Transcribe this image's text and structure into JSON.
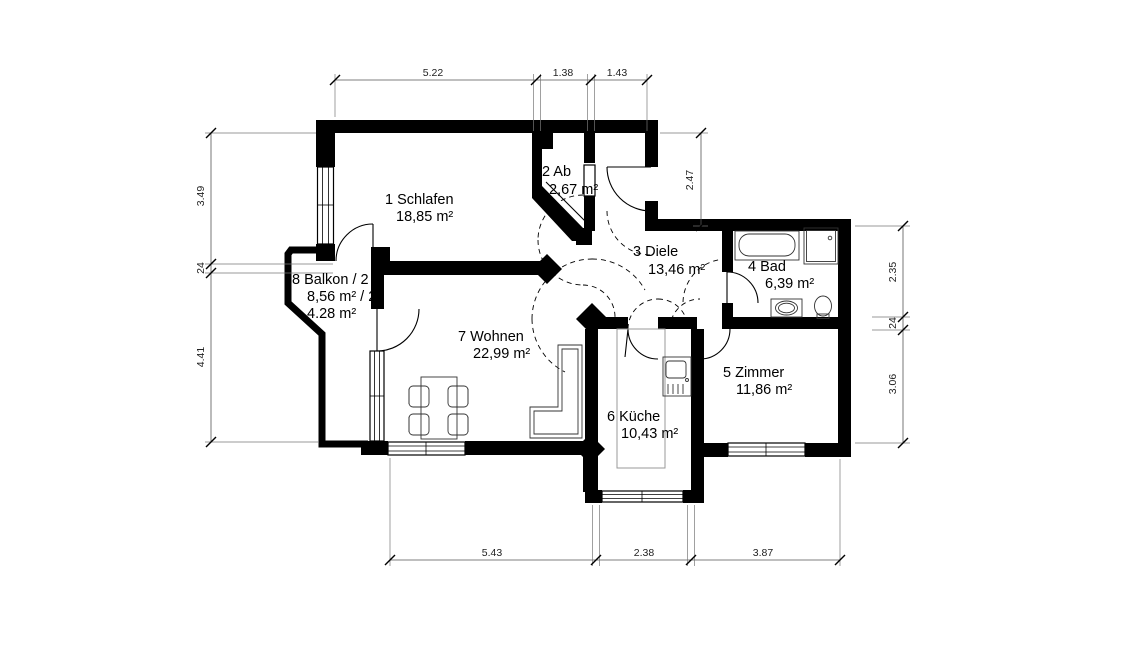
{
  "rooms": [
    {
      "label": "1  Schlafen",
      "area": "18,85 m²"
    },
    {
      "label": "2  Ab",
      "area": "2,67 m²"
    },
    {
      "label": "3  Diele",
      "area": "13,46 m²"
    },
    {
      "label": "4  Bad",
      "area": "6,39 m²"
    },
    {
      "label": "5  Zimmer",
      "area": "11,86 m²"
    },
    {
      "label": "6  Küche",
      "area": "10,43 m²"
    },
    {
      "label": "7  Wohnen",
      "area": "22,99 m²"
    },
    {
      "label": "8  Balkon / 2",
      "area": "8,56 m² / 2",
      "area2": "4.28 m²"
    }
  ],
  "dimensions": {
    "top": [
      "5.22",
      "1.38",
      "1.43"
    ],
    "bottom": [
      "5.43",
      "2.38",
      "3.87"
    ],
    "left": [
      "3.49",
      "24",
      "4.41"
    ],
    "right_inner": [
      "2.47"
    ],
    "right": [
      "2.35",
      "24",
      "3.06"
    ]
  },
  "colors": {
    "wall": "#000000",
    "background": "#ffffff"
  }
}
